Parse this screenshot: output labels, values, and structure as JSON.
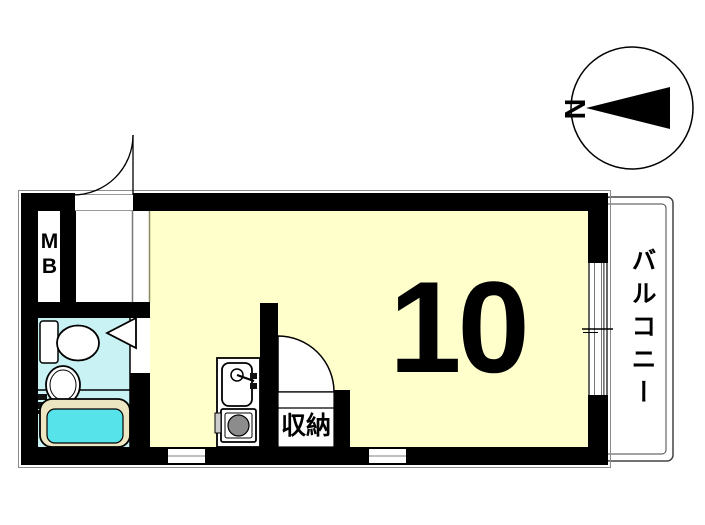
{
  "floorplan": {
    "main_room": {
      "label": "10"
    },
    "storage": {
      "label": "収納"
    },
    "balcony": {
      "label": "バルコニー"
    },
    "meter_box": {
      "label": "MB"
    },
    "compass": {
      "north_label": "N"
    },
    "colors": {
      "room_floor": "#FFFFCC",
      "bathroom_floor": "#C9F2F4",
      "bathtub_water": "#57E3EA",
      "bathtub_rim": "#EDE6C2",
      "wall": "#000000",
      "stove_burner": "#8C8C8C"
    }
  }
}
